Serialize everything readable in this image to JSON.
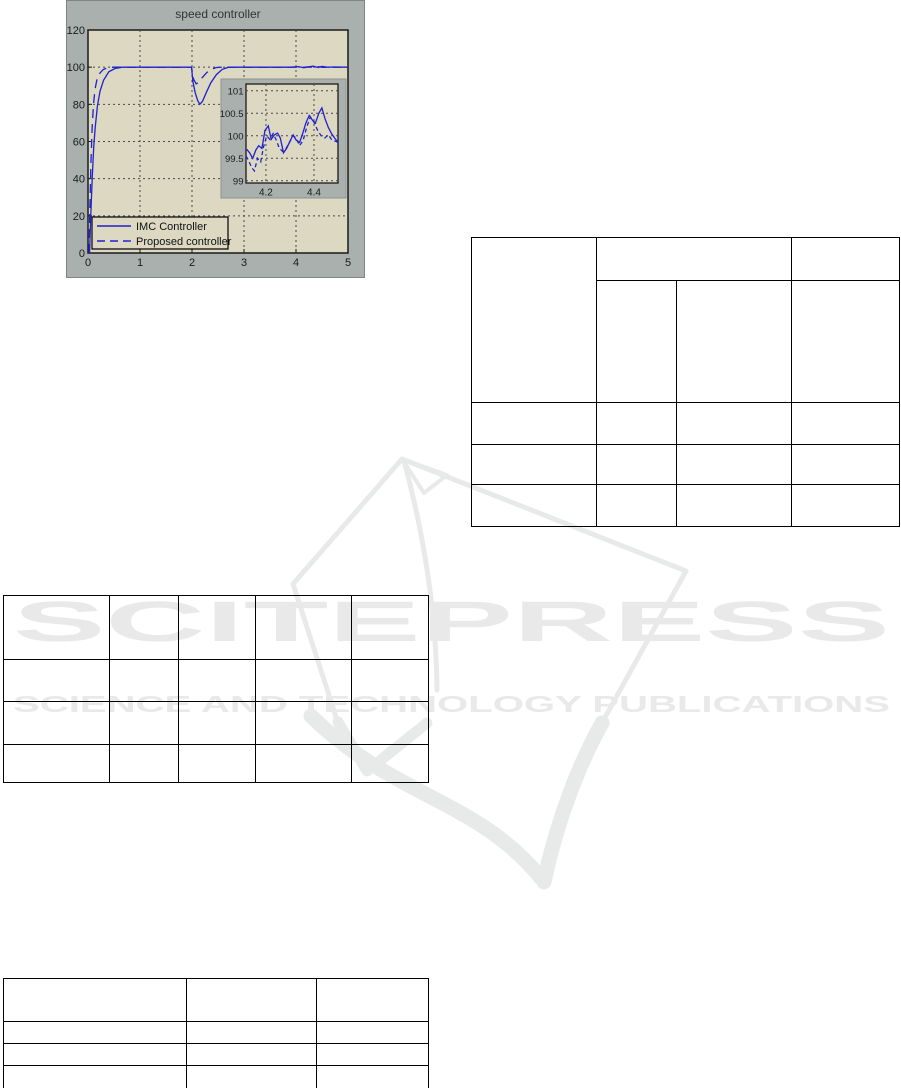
{
  "watermark": {
    "brand_text": "SCITEPRESS",
    "tagline_text": "SCIENCE AND TECHNOLOGY PUBLICATIONS",
    "color": "#e9e9e9",
    "logo_icon": "scitepress-open-book-logo"
  },
  "chart_data": {
    "type": "line",
    "title": "speed controller",
    "xlabel": "",
    "ylabel": "",
    "xlim": [
      0,
      5
    ],
    "ylim": [
      0,
      120
    ],
    "x_ticks": [
      0,
      1,
      2,
      3,
      4,
      5
    ],
    "y_ticks": [
      0,
      20,
      40,
      60,
      80,
      100,
      120
    ],
    "grid": true,
    "legend_position": "lower-left",
    "colors": {
      "figure_bg": "#a9b0ad",
      "axes_bg": "#dcd8c2",
      "line": "#2121cd",
      "grid_line": "#4a4a4a",
      "title_text": "#333333",
      "tick_text": "#1a1a1a"
    },
    "series": [
      {
        "name": "IMC Controller",
        "style": "solid",
        "x": [
          0.03,
          0.05,
          0.08,
          0.11,
          0.14,
          0.18,
          0.23,
          0.3,
          0.4,
          0.52,
          0.66,
          0.85,
          1.99,
          2.02,
          2.06,
          2.11,
          2.15,
          2.2,
          2.27,
          2.36,
          2.47,
          2.58,
          2.7,
          2.85,
          3.1,
          3.5,
          3.9,
          4.05,
          4.15,
          4.25,
          4.33,
          4.42,
          4.5,
          4.6,
          4.75,
          5.0
        ],
        "y": [
          0,
          18,
          40,
          57,
          68,
          79,
          87,
          93,
          97.5,
          99.3,
          100,
          100,
          100,
          92,
          86.5,
          82,
          80,
          81.5,
          86,
          91.5,
          96,
          98.8,
          100,
          100,
          100,
          100,
          100,
          100.3,
          99.7,
          100.2,
          100.5,
          99.8,
          100.4,
          100,
          100.1,
          100
        ]
      },
      {
        "name": "Proposed controller",
        "style": "dashed",
        "x": [
          0.02,
          0.035,
          0.055,
          0.08,
          0.105,
          0.135,
          0.17,
          0.22,
          0.29,
          0.38,
          0.5,
          1.99,
          2.03,
          2.08,
          2.13,
          2.2,
          2.28,
          2.37,
          2.47,
          2.6,
          3.0,
          3.5,
          4.0,
          4.12,
          4.22,
          4.32,
          4.42,
          4.52,
          4.65,
          4.8,
          5.0
        ],
        "y": [
          0,
          22,
          48,
          68,
          80,
          88,
          93,
          96.5,
          98.7,
          99.8,
          100,
          100,
          93.5,
          91,
          92,
          94.5,
          97,
          98.8,
          99.8,
          100,
          100,
          100,
          100,
          99.8,
          100.15,
          99.85,
          100.25,
          99.9,
          100.1,
          100,
          100
        ]
      }
    ],
    "inset": {
      "xlim": [
        4.117,
        4.5
      ],
      "ylim": [
        98.95,
        101.15
      ],
      "x_ticks": [
        4.2,
        4.4
      ],
      "y_ticks": [
        99,
        99.5,
        100,
        100.5,
        101
      ],
      "series": [
        {
          "name": "IMC Controller",
          "style": "solid",
          "x": [
            4.12,
            4.132,
            4.145,
            4.158,
            4.17,
            4.183,
            4.196,
            4.21,
            4.222,
            4.235,
            4.248,
            4.26,
            4.273,
            4.286,
            4.3,
            4.313,
            4.326,
            4.34,
            4.353,
            4.366,
            4.38,
            4.393,
            4.406,
            4.42,
            4.433,
            4.446,
            4.46,
            4.473,
            4.486,
            4.5
          ],
          "y": [
            99.7,
            99.62,
            99.5,
            99.68,
            99.78,
            99.72,
            100.12,
            100.22,
            99.92,
            100.02,
            100.06,
            99.95,
            99.62,
            99.72,
            99.88,
            100.02,
            99.9,
            99.85,
            100.05,
            100.28,
            100.45,
            100.35,
            100.28,
            100.5,
            100.62,
            100.38,
            100.18,
            100.05,
            99.95,
            99.85
          ]
        },
        {
          "name": "Proposed controller",
          "style": "dashed",
          "x": [
            4.117,
            4.128,
            4.14,
            4.152,
            4.165,
            4.178,
            4.19,
            4.203,
            4.216,
            4.23,
            4.243,
            4.256,
            4.27,
            4.284,
            4.298,
            4.312,
            4.326,
            4.34,
            4.355,
            4.37,
            4.385,
            4.4,
            4.415,
            4.43,
            4.445,
            4.46,
            4.475,
            4.49,
            4.5
          ],
          "y": [
            99.55,
            99.45,
            99.3,
            99.22,
            99.5,
            99.42,
            99.75,
            100.0,
            99.92,
            100.05,
            99.9,
            99.72,
            99.65,
            99.72,
            99.85,
            100.0,
            99.95,
            99.78,
            99.9,
            100.2,
            100.42,
            100.3,
            100.12,
            100.0,
            99.95,
            100.02,
            99.9,
            99.88,
            99.85
          ]
        }
      ]
    }
  },
  "tables": {
    "top_right": {
      "cells": [
        [
          "",
          "",
          ""
        ],
        [
          "",
          "",
          ""
        ],
        [
          "",
          "",
          "",
          ""
        ],
        [
          "",
          "",
          "",
          ""
        ],
        [
          "",
          "",
          "",
          ""
        ]
      ]
    },
    "middle_left": {
      "cells": [
        [
          "",
          "",
          "",
          "",
          ""
        ],
        [
          "",
          "",
          "",
          "",
          ""
        ],
        [
          "",
          "",
          "",
          "",
          ""
        ],
        [
          "",
          "",
          "",
          "",
          ""
        ]
      ]
    },
    "bottom_left": {
      "cells": [
        [
          "",
          "",
          ""
        ],
        [
          "",
          "",
          ""
        ],
        [
          "",
          "",
          ""
        ],
        [
          "",
          "",
          ""
        ]
      ]
    }
  }
}
